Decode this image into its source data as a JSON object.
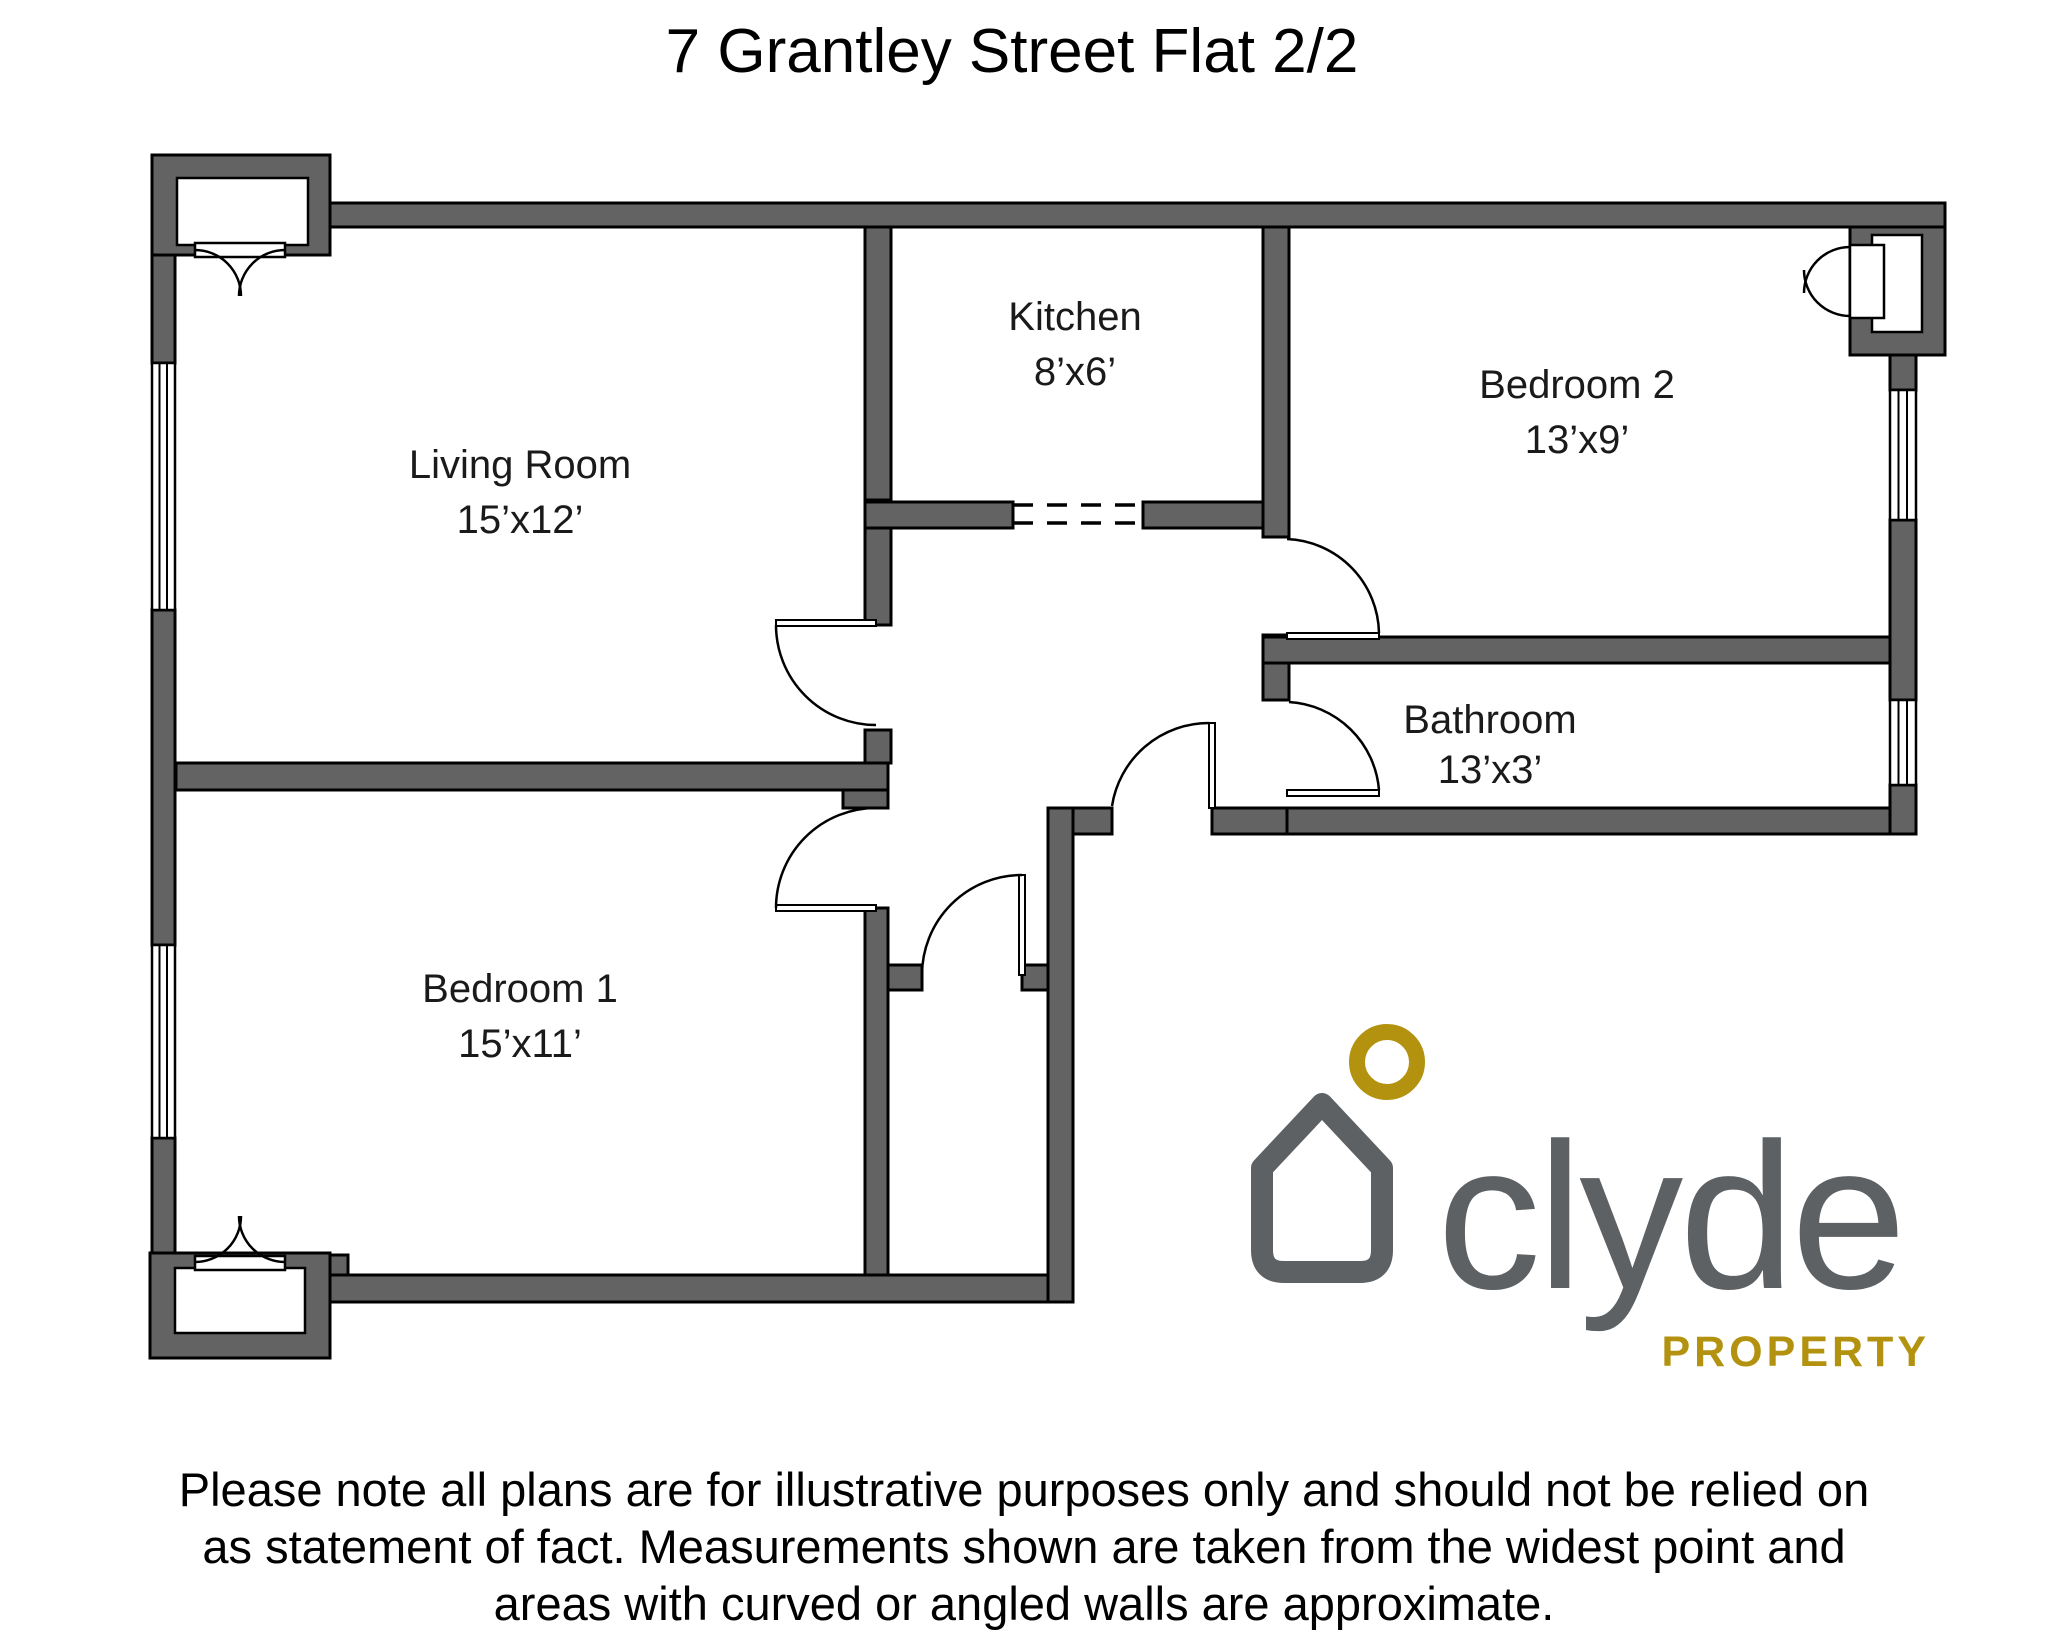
{
  "title": "7 Grantley Street Flat 2/2",
  "rooms": [
    {
      "name": "Living Room",
      "dims": "15’x12’"
    },
    {
      "name": "Kitchen",
      "dims": "8’x6’"
    },
    {
      "name": "Bedroom 2",
      "dims": "13’x9’"
    },
    {
      "name": "Bathroom",
      "dims": "13’x3’"
    },
    {
      "name": "Bedroom 1",
      "dims": "15’x11’"
    }
  ],
  "logo": {
    "brand": "clyde",
    "tagline": "PROPERTY"
  },
  "disclaimer": {
    "lines": [
      "Please note all plans are for illustrative purposes only and should not be relied on",
      "as statement of fact. Measurements shown are taken from the widest point and",
      "areas with curved or angled walls are approximate."
    ]
  },
  "colors": {
    "wall_fill": "#636363",
    "outline": "#000000",
    "logo_gray": "#5d6164",
    "logo_gold": "#b2920e"
  }
}
